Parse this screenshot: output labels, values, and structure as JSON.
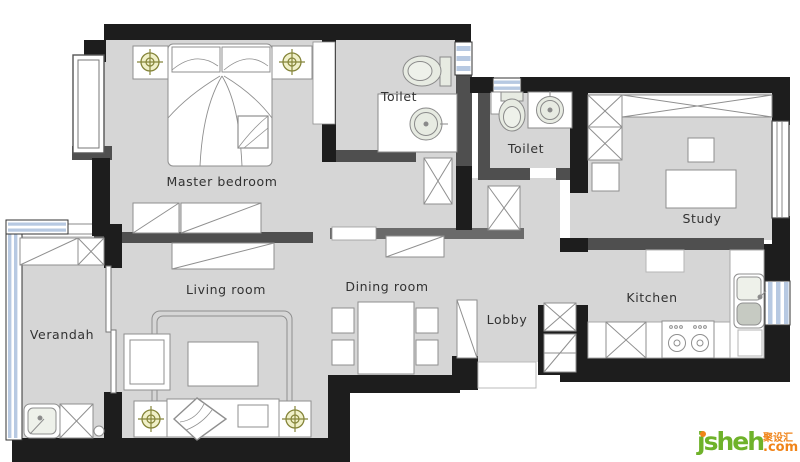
{
  "rooms": [
    {
      "id": "master-bedroom",
      "label": "Master bedroom"
    },
    {
      "id": "toilet-1",
      "label": "Toilet"
    },
    {
      "id": "toilet-2",
      "label": "Toilet"
    },
    {
      "id": "study",
      "label": "Study"
    },
    {
      "id": "living-room",
      "label": "Living room"
    },
    {
      "id": "dining-room",
      "label": "Dining room"
    },
    {
      "id": "lobby",
      "label": "Lobby"
    },
    {
      "id": "kitchen",
      "label": "Kitchen"
    },
    {
      "id": "verandah",
      "label": "Verandah"
    }
  ],
  "logo": {
    "brand": "jsheh",
    "cn_tag": "聚设汇",
    "suffix": ".com"
  },
  "colors": {
    "floor": "#d6d6d6",
    "outer_wall": "#1d1d1d",
    "partition_wall": "#4f4f4f",
    "light_partition_wall": "#6a6a6a",
    "window_glass": "#b7c9e2",
    "fixture_fill": "#e7ebe2",
    "light_symbol": "#85853a",
    "light_symbol_fill": "#f0f0c8",
    "furniture_stroke": "#8f8f8f",
    "logo_green": "#6fb22a",
    "logo_orange": "#f08419"
  }
}
